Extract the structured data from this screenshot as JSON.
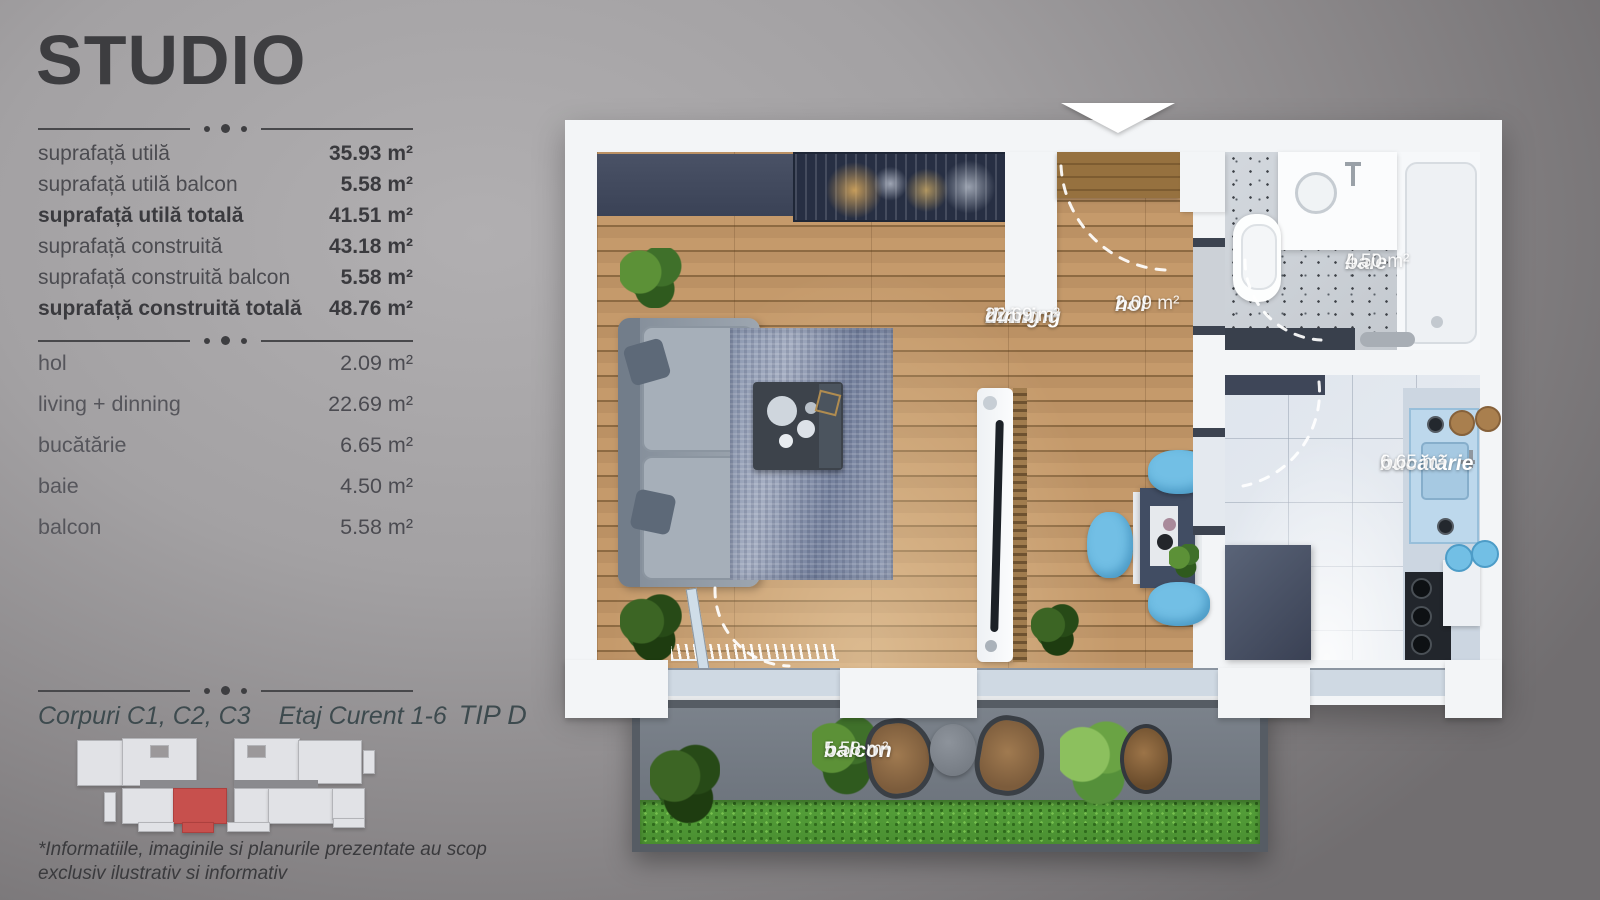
{
  "panel": {
    "title": "STUDIO",
    "specs": [
      {
        "label": "suprafață utilă",
        "value": "35.93 m²"
      },
      {
        "label": "suprafață utilă balcon",
        "value": "5.58 m²"
      },
      {
        "label": "suprafață utilă totală",
        "value": "41.51 m²"
      },
      {
        "label": "suprafață construită",
        "value": "43.18 m²"
      },
      {
        "label": "suprafață construită balcon",
        "value": "5.58 m²"
      },
      {
        "label": "suprafață construită totală",
        "value": "48.76 m²"
      }
    ],
    "rooms": [
      {
        "label": "hol",
        "value": "2.09 m²"
      },
      {
        "label": "living + dinning",
        "value": "22.69 m²"
      },
      {
        "label": "bucătărie",
        "value": "6.65 m²"
      },
      {
        "label": "baie",
        "value": "4.50 m²"
      },
      {
        "label": "balcon",
        "value": "5.58 m²"
      }
    ],
    "footer": {
      "corpuri": "Corpuri C1, C2, C3",
      "etaj": "Etaj Curent 1-6",
      "tip": "TIP D",
      "disclaimer1": "*Informatiile, imaginile si planurile prezentate au scop",
      "disclaimer2": "exclusiv ilustrativ si informativ"
    }
  },
  "plan": {
    "labels": {
      "living": {
        "name1": "living +",
        "name2": "dinning",
        "area": "22.69 m²"
      },
      "hol": {
        "name": "hol",
        "area": "2.09 m²"
      },
      "baie": {
        "name": "baie",
        "area": "4.50 m²"
      },
      "bucatarie": {
        "name": "bucătărie",
        "area": "6.65 m²"
      },
      "balcon": {
        "name": "balcon",
        "area": "5.58 m²"
      }
    }
  },
  "colors": {
    "accent_red": "#c7504d",
    "navy_furniture": "#3e4658",
    "wood_floor": "#b5895a",
    "chair_blue": "#72bfe5",
    "grass_green": "#55a13a",
    "wall_white": "#f3f5f7",
    "balcony_floor": "#757c85",
    "text_dark": "#3a3a3e",
    "label_white": "#ffffff"
  }
}
